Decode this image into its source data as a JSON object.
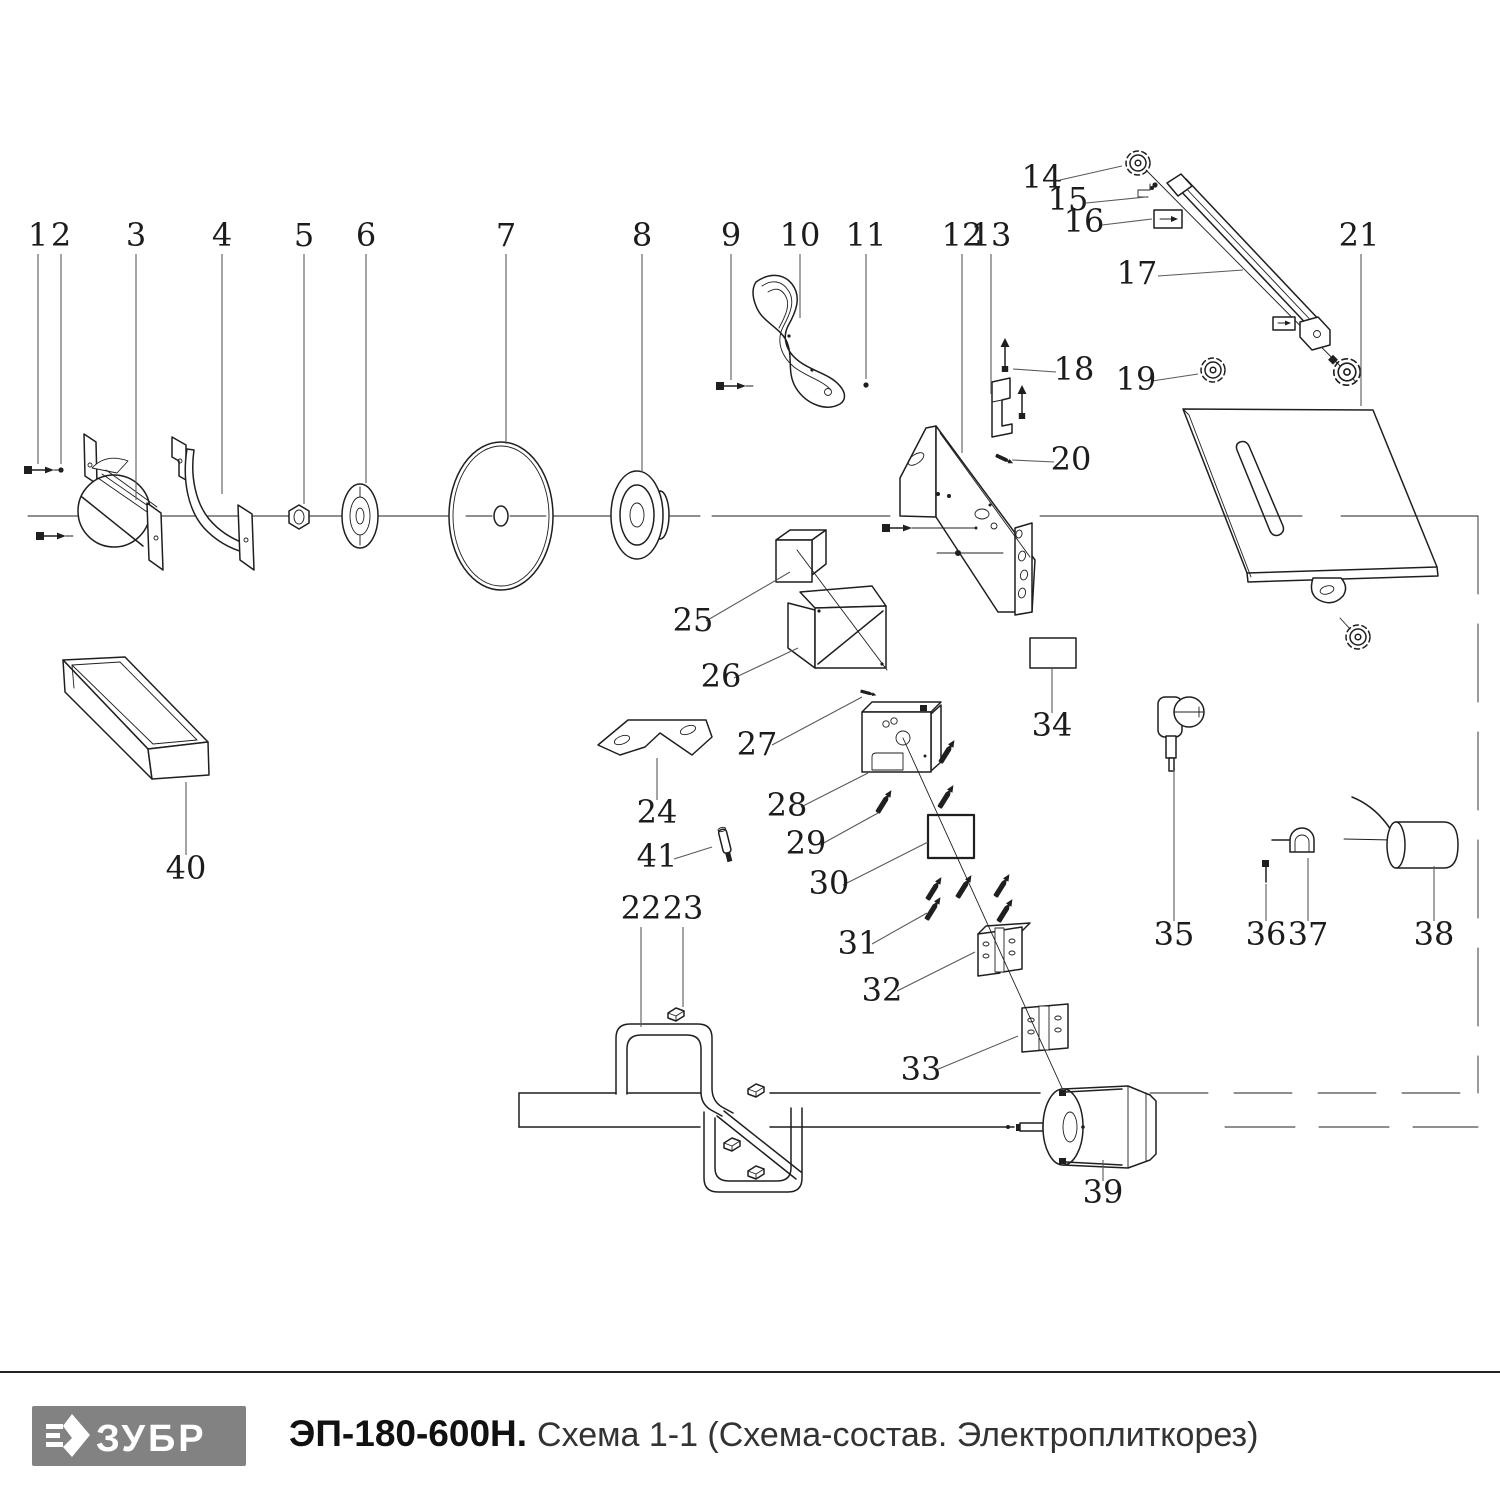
{
  "footer": {
    "brand": "ЗУБР",
    "model": "ЭП-180-600Н.",
    "schema": "Схема 1-1 (Схема-состав. Электроплиткорез)",
    "logo_bg": "#828282",
    "logo_fg": "#ffffff"
  },
  "diagram": {
    "stroke_color": "#1f1f1f",
    "leader_color": "#5a5a5a",
    "label_font_size": 32,
    "labels": [
      {
        "t": "1",
        "x": 38,
        "y": 246,
        "l": [
          38,
          254,
          38,
          464
        ]
      },
      {
        "t": "2",
        "x": 61,
        "y": 246,
        "l": [
          61,
          254,
          61,
          464
        ]
      },
      {
        "t": "3",
        "x": 136,
        "y": 246,
        "l": [
          136,
          254,
          136,
          500
        ]
      },
      {
        "t": "4",
        "x": 222,
        "y": 246,
        "l": [
          222,
          254,
          222,
          494
        ]
      },
      {
        "t": "5",
        "x": 304,
        "y": 246,
        "l": [
          304,
          254,
          304,
          504
        ]
      },
      {
        "t": "6",
        "x": 366,
        "y": 246,
        "l": [
          366,
          254,
          366,
          483
        ]
      },
      {
        "t": "7",
        "x": 506,
        "y": 246,
        "l": [
          506,
          254,
          506,
          444
        ]
      },
      {
        "t": "8",
        "x": 642,
        "y": 246,
        "l": [
          642,
          254,
          642,
          472
        ]
      },
      {
        "t": "9",
        "x": 731,
        "y": 246,
        "l": [
          731,
          254,
          731,
          380
        ]
      },
      {
        "t": "10",
        "x": 800,
        "y": 246,
        "l": [
          800,
          254,
          800,
          318
        ]
      },
      {
        "t": "11",
        "x": 866,
        "y": 246,
        "l": [
          866,
          254,
          866,
          379
        ]
      },
      {
        "t": "12",
        "x": 962,
        "y": 246,
        "l": [
          962,
          254,
          962,
          453
        ]
      },
      {
        "t": "13",
        "x": 991,
        "y": 246,
        "l": [
          991,
          254,
          991,
          394
        ]
      },
      {
        "t": "14",
        "x": 1042,
        "y": 188,
        "l": [
          1060,
          180,
          1122,
          166
        ]
      },
      {
        "t": "15",
        "x": 1068,
        "y": 210,
        "l": [
          1086,
          203,
          1146,
          197
        ]
      },
      {
        "t": "16",
        "x": 1084,
        "y": 232,
        "l": [
          1102,
          225,
          1152,
          219
        ]
      },
      {
        "t": "17",
        "x": 1137,
        "y": 284,
        "l": [
          1158,
          276,
          1243,
          270
        ]
      },
      {
        "t": "18",
        "x": 1074,
        "y": 380,
        "l": [
          1056,
          372,
          1013,
          369
        ]
      },
      {
        "t": "19",
        "x": 1136,
        "y": 390,
        "l": [
          1152,
          381,
          1198,
          374
        ]
      },
      {
        "t": "20",
        "x": 1071,
        "y": 470,
        "l": [
          1054,
          462,
          1012,
          460
        ]
      },
      {
        "t": "21",
        "x": 1359,
        "y": 246,
        "l": [
          1361,
          254,
          1361,
          406
        ]
      },
      {
        "t": "22",
        "x": 641,
        "y": 919,
        "l": [
          641,
          927,
          641,
          1027
        ]
      },
      {
        "t": "23",
        "x": 683,
        "y": 919,
        "l": [
          683,
          927,
          683,
          1007
        ]
      },
      {
        "t": "24",
        "x": 657,
        "y": 823,
        "l": [
          657,
          800,
          657,
          758
        ]
      },
      {
        "t": "25",
        "x": 693,
        "y": 631,
        "l": [
          706,
          621,
          790,
          572
        ]
      },
      {
        "t": "26",
        "x": 721,
        "y": 687,
        "l": [
          734,
          678,
          798,
          648
        ]
      },
      {
        "t": "27",
        "x": 757,
        "y": 755,
        "l": [
          772,
          745,
          862,
          697
        ]
      },
      {
        "t": "28",
        "x": 787,
        "y": 816,
        "l": [
          801,
          807,
          868,
          773
        ]
      },
      {
        "t": "29",
        "x": 806,
        "y": 854,
        "l": [
          820,
          845,
          878,
          813
        ]
      },
      {
        "t": "30",
        "x": 829,
        "y": 894,
        "l": [
          843,
          885,
          928,
          842
        ]
      },
      {
        "t": "31",
        "x": 858,
        "y": 954,
        "l": [
          872,
          944,
          927,
          913
        ]
      },
      {
        "t": "32",
        "x": 882,
        "y": 1001,
        "l": [
          897,
          991,
          975,
          952
        ]
      },
      {
        "t": "33",
        "x": 921,
        "y": 1080,
        "l": [
          936,
          1070,
          1018,
          1036
        ]
      },
      {
        "t": "34",
        "x": 1052,
        "y": 736,
        "l": [
          1052,
          713,
          1052,
          668
        ]
      },
      {
        "t": "35",
        "x": 1174,
        "y": 945,
        "l": [
          1174,
          921,
          1174,
          770
        ]
      },
      {
        "t": "36",
        "x": 1266,
        "y": 945,
        "l": [
          1266,
          921,
          1266,
          884
        ]
      },
      {
        "t": "37",
        "x": 1308,
        "y": 945,
        "l": [
          1308,
          921,
          1308,
          858
        ]
      },
      {
        "t": "38",
        "x": 1434,
        "y": 945,
        "l": [
          1434,
          921,
          1434,
          866
        ]
      },
      {
        "t": "39",
        "x": 1103,
        "y": 1203,
        "l": [
          1103,
          1181,
          1103,
          1160
        ]
      },
      {
        "t": "40",
        "x": 186,
        "y": 879,
        "l": [
          186,
          855,
          186,
          782
        ]
      },
      {
        "t": "41",
        "x": 657,
        "y": 867,
        "l": [
          674,
          859,
          712,
          847
        ]
      }
    ]
  }
}
